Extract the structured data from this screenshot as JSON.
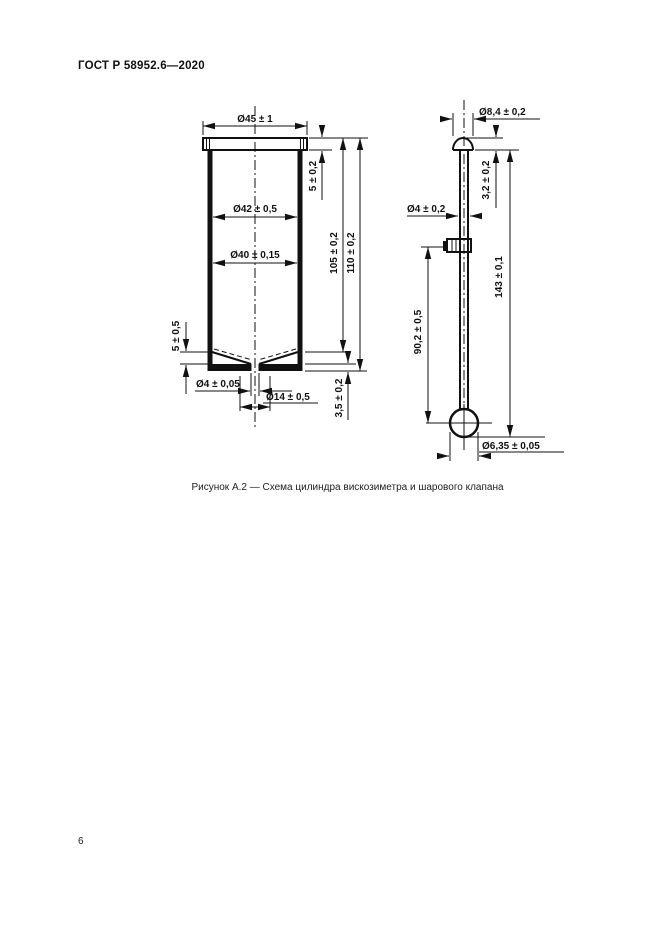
{
  "page": {
    "header": "ГОСТ Р 58952.6—2020",
    "caption": "Рисунок А.2 — Схема цилиндра вискозиметра и шарового клапана",
    "page_number": "6"
  },
  "cylinder": {
    "flange_diameter": "Ø45 ± 1",
    "bore_upper": "Ø42 ± 0,5",
    "bore_lower": "Ø40 ± 0,15",
    "flange_height": "5 ± 0,2",
    "inner_depth": "105 ± 0,2",
    "total_height": "110 ± 0,2",
    "cone_depth": "5 ± 0,5",
    "orifice_diameter": "Ø4 ± 0,05",
    "seat_diameter": "Ø14 ± 0,5",
    "base_thickness": "3,5 ± 0,2"
  },
  "valve": {
    "head_diameter": "Ø8,4 ± 0,2",
    "head_height": "3,2 ± 0,2",
    "rod_diameter": "Ø4 ± 0,2",
    "rod_length": "90,2 ± 0,5",
    "total_length": "143 ± 0,1",
    "ball_diameter": "Ø6,35 ± 0,05"
  }
}
